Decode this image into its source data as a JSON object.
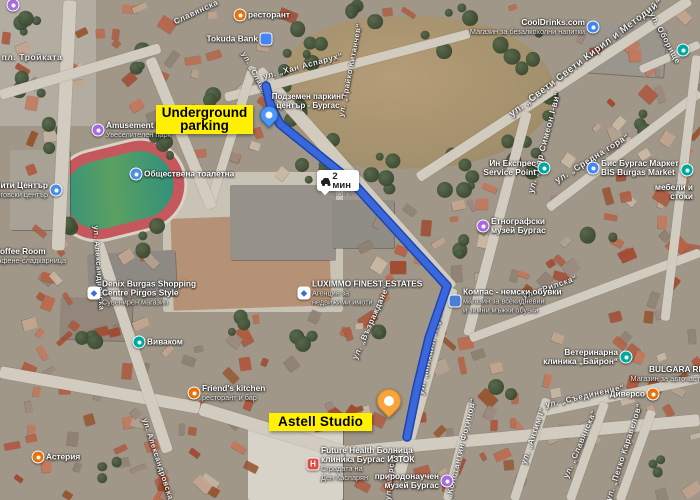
{
  "map": {
    "type": "satellite",
    "route": {
      "color": "#3b67dd",
      "outline": "#1c46ad",
      "points": [
        [
          266,
          86
        ],
        [
          271,
          107
        ],
        [
          280,
          124
        ],
        [
          352,
          182
        ],
        [
          447,
          286
        ],
        [
          429,
          338
        ],
        [
          417,
          388
        ],
        [
          407,
          437
        ]
      ],
      "badge": {
        "mode": "driving",
        "duration": "2 мин",
        "distance": "350 m"
      }
    },
    "markers": {
      "start": {
        "label_lines": [
          "Подземен паркинг",
          "център - Бургас"
        ],
        "x": 269,
        "y": 127,
        "color": "#4a97f5"
      },
      "end": {
        "x": 389,
        "y": 416,
        "color": "#f7a43c"
      }
    },
    "annotations": {
      "underground": {
        "line1": "Underground",
        "line2": "parking",
        "bg": "#fff100"
      },
      "astell": {
        "text": "Astell Studio",
        "bg": "#fff100"
      }
    },
    "icon_styles": {
      "restaurant": {
        "shape": "circle",
        "color": "#e8710a"
      },
      "bank": {
        "shape": "square",
        "color": "#4285f4"
      },
      "shop": {
        "shape": "circle",
        "color": "#4285f4"
      },
      "attraction": {
        "shape": "circle",
        "color": "#a86ae3"
      },
      "museum": {
        "shape": "circle",
        "color": "#a86ae3"
      },
      "toilet": {
        "shape": "circle",
        "color": "#4a90e2"
      },
      "mall": {
        "shape": "circle",
        "color": "#4a90e2"
      },
      "telecom": {
        "shape": "circle",
        "color": "#00a9a0"
      },
      "teal": {
        "shape": "circle",
        "color": "#00a9a0"
      },
      "vet": {
        "shape": "circle",
        "color": "#00a9a0"
      },
      "market": {
        "shape": "circle",
        "color": "#4285f4"
      },
      "hospital": {
        "shape": "square",
        "color": "#dd4b42",
        "glyph": "H",
        "glyph_color": "#ffffff"
      },
      "shoes": {
        "shape": "square",
        "color": "#4a7dd6"
      },
      "store": {
        "shape": "square",
        "color": "#ffffff",
        "glyph": "◆",
        "glyph_color": "#3b6fd4"
      }
    },
    "pois": [
      {
        "id": "troykata-attraction",
        "type": "attraction",
        "x": 13,
        "y": 5,
        "side": "right",
        "name": "",
        "name2": "",
        "sub": []
      },
      {
        "id": "restaurant-north",
        "type": "restaurant",
        "x": 240,
        "y": 15,
        "side": "right",
        "name": "ресторант",
        "name2": "",
        "sub": []
      },
      {
        "id": "tokuda-bank",
        "type": "bank",
        "x": 266,
        "y": 39,
        "side": "left",
        "name": "Tokuda Bank",
        "name2": "",
        "sub": []
      },
      {
        "id": "cooldrinks",
        "type": "shop",
        "x": 593,
        "y": 27,
        "side": "left",
        "name": "CoolDrinks.com",
        "name2": "",
        "sub": [
          "Магазин за безалкохолни напитки"
        ]
      },
      {
        "id": "poi-northeast",
        "type": "teal",
        "x": 683,
        "y": 50,
        "side": "right",
        "name": "",
        "name2": "",
        "sub": []
      },
      {
        "id": "amusement-park",
        "type": "attraction",
        "x": 98,
        "y": 130,
        "side": "right",
        "name": "Amusement Park",
        "name2": "",
        "sub": [
          "Увеселителен парк"
        ]
      },
      {
        "id": "public-toilet",
        "type": "toilet",
        "x": 136,
        "y": 174,
        "side": "right",
        "name": "Обществена тоалетна",
        "name2": "",
        "sub": []
      },
      {
        "id": "city-center-mall",
        "type": "mall",
        "x": 56,
        "y": 190,
        "side": "left",
        "name": "Сити Център",
        "name2": "",
        "sub": [
          "търговски център"
        ]
      },
      {
        "id": "coffee-room",
        "type": null,
        "x": -14,
        "y": 256,
        "side": "right",
        "name": "Coffee Room",
        "name2": "",
        "sub": [
          "кафене-сладкарница"
        ]
      },
      {
        "id": "demix-shopping",
        "type": "store",
        "x": 94,
        "y": 293,
        "side": "right",
        "name": "Denix Burgas Shopping",
        "name2": "Centre Pirgos Style",
        "sub": [
          "Сувенирен магазин"
        ]
      },
      {
        "id": "vivacom",
        "type": "telecom",
        "x": 139,
        "y": 342,
        "side": "right",
        "name": "Виваком",
        "name2": "",
        "sub": []
      },
      {
        "id": "luximmo",
        "type": "store",
        "x": 304,
        "y": 293,
        "side": "right",
        "name": "LUXIMMO FINEST ESTATES",
        "name2": "",
        "sub": [
          "Агенция за",
          "недвижими имоти"
        ]
      },
      {
        "id": "kompas-shoes",
        "type": "shoes",
        "x": 455,
        "y": 301,
        "side": "right",
        "name": "Компас - немски обувки",
        "name2": "",
        "sub": [
          "магазин за всекидневни",
          "и зимни мъжки обувки"
        ]
      },
      {
        "id": "in-express",
        "type": "teal",
        "x": 544,
        "y": 168,
        "side": "left",
        "name": "Ин Експрес",
        "name2": "Service Point",
        "sub": []
      },
      {
        "id": "bis-market",
        "type": "market",
        "x": 593,
        "y": 168,
        "side": "right",
        "name": "Бис Бургас Маркет",
        "name2": "BIS Burgas Market",
        "sub": []
      },
      {
        "id": "furniture-store",
        "type": "teal",
        "x": 687,
        "y": 170,
        "side": "below",
        "name": "мебели и",
        "name2": "стоки",
        "sub": []
      },
      {
        "id": "etno-museum",
        "type": "museum",
        "x": 483,
        "y": 226,
        "side": "right",
        "name": "Етнографски",
        "name2": "музей Бургас",
        "sub": []
      },
      {
        "id": "vet-clinic",
        "type": "vet",
        "x": 626,
        "y": 357,
        "side": "left",
        "name": "Ветеринарна",
        "name2": "клиника „Байрон“",
        "sub": []
      },
      {
        "id": "bulgara",
        "type": null,
        "x": 712,
        "y": 374,
        "side": "left",
        "name": "BULGARA RE",
        "name2": "",
        "sub": [
          "Магазин за авточасти"
        ]
      },
      {
        "id": "diverso",
        "type": "restaurant",
        "x": 653,
        "y": 394,
        "side": "left",
        "name": "Диверсо",
        "name2": "",
        "sub": []
      },
      {
        "id": "friends-kitchen",
        "type": "restaurant",
        "x": 194,
        "y": 393,
        "side": "right",
        "name": "Friend's kitchen",
        "name2": "",
        "sub": [
          "ресторант и бар"
        ]
      },
      {
        "id": "asteria",
        "type": "restaurant",
        "x": 38,
        "y": 457,
        "side": "right",
        "name": "Астерия",
        "name2": "",
        "sub": []
      },
      {
        "id": "future-health",
        "type": "hospital",
        "x": 313,
        "y": 464,
        "side": "right",
        "name": "Future Health Болница",
        "name2": "клиника Бургас ИЗТОК",
        "sub": [
          "Сградата на",
          "Ден Каспарян"
        ]
      },
      {
        "id": "nat-museum",
        "type": "museum",
        "x": 447,
        "y": 481,
        "side": "left",
        "name": "природонаучен",
        "name2": "музей Бургас",
        "sub": []
      }
    ],
    "streets": [
      {
        "name": "Славянска",
        "x": 196,
        "y": 12,
        "rot": -25,
        "size": 8
      },
      {
        "name": "ул. „Хан Аспарух“",
        "x": 303,
        "y": 66,
        "rot": -15,
        "size": 8
      },
      {
        "name": "ул. „Славянска“",
        "x": 260,
        "y": 83,
        "rot": 62,
        "size": 7.5
      },
      {
        "name": "ул. „Трайко Китанчев“",
        "x": 350,
        "y": 70,
        "rot": -79,
        "size": 7.5
      },
      {
        "name": "ул. „Свети Свети Кирил и Методий“",
        "x": 586,
        "y": 58,
        "rot": -37,
        "size": 9.5
      },
      {
        "name": "ул. Оборище",
        "x": 665,
        "y": 38,
        "rot": 62,
        "size": 8
      },
      {
        "name": "ул. „Цар Симеон I-ви“",
        "x": 544,
        "y": 142,
        "rot": -75,
        "size": 8.5
      },
      {
        "name": "ул. „Средна гора“",
        "x": 592,
        "y": 158,
        "rot": -32,
        "size": 8.5
      },
      {
        "name": "ул. „Рилска“",
        "x": 550,
        "y": 287,
        "rot": -19,
        "size": 8
      },
      {
        "name": "ул. „Възраждане“",
        "x": 371,
        "y": 322,
        "rot": -66,
        "size": 8
      },
      {
        "name": "ул. „Михаил Лермонтов“",
        "x": 433,
        "y": 337,
        "rot": -77,
        "size": 8.5
      },
      {
        "name": "ул. Александровска",
        "x": 99,
        "y": 268,
        "rot": 86,
        "size": 7.5
      },
      {
        "name": "ул. Александровска",
        "x": 158,
        "y": 459,
        "rot": 72,
        "size": 7.5
      },
      {
        "name": "ул. „Съединение“",
        "x": 585,
        "y": 396,
        "rot": -13,
        "size": 8
      },
      {
        "name": "ул. „Константин Фотинов“",
        "x": 459,
        "y": 456,
        "rot": -76,
        "size": 8
      },
      {
        "name": "ул. „Антим I“",
        "x": 533,
        "y": 436,
        "rot": -71,
        "size": 8
      },
      {
        "name": "ул. „Славянска“",
        "x": 580,
        "y": 444,
        "rot": -67,
        "size": 8
      },
      {
        "name": "ул. „Петко Каравелов“",
        "x": 624,
        "y": 452,
        "rot": -72,
        "size": 8
      },
      {
        "name": "ул. Морска",
        "x": 390,
        "y": 477,
        "rot": -84,
        "size": 7.5
      },
      {
        "name": "пл. Тройката",
        "x": 32,
        "y": 57,
        "rot": 0,
        "size": 8.5
      }
    ]
  }
}
